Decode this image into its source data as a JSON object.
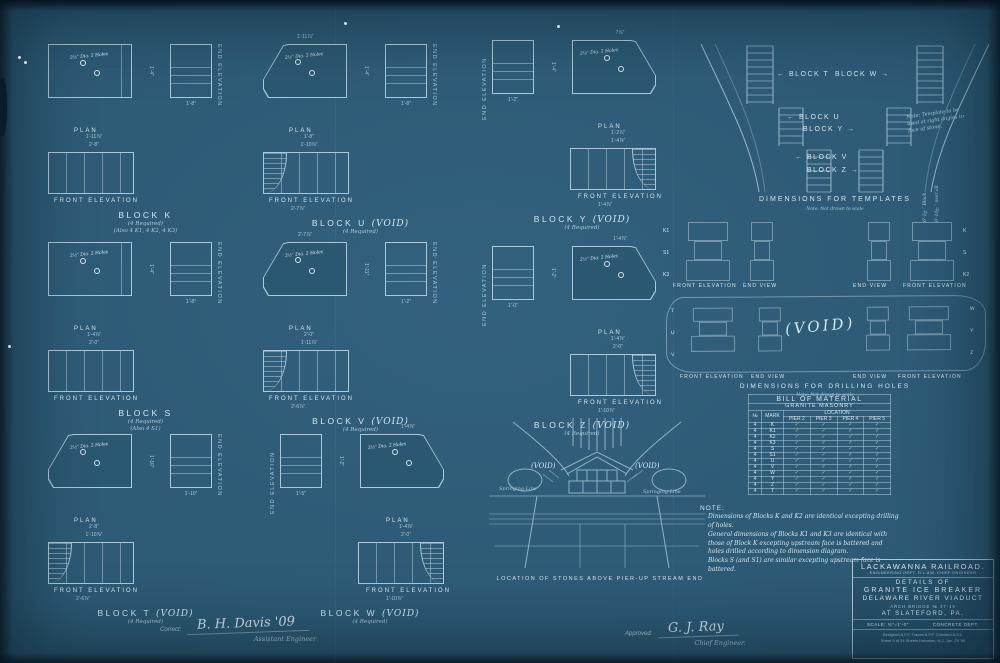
{
  "labels": {
    "plan": "PLAN",
    "front": "FRONT ELEVATION",
    "end": "END ELEVATION"
  },
  "blocks": [
    {
      "title": "BLOCK K",
      "void": "",
      "required": "(4 Required)",
      "extra": "(Also 4 K1, 4 K2, 4 K3)",
      "holes": "2½″ Dia. 2 Holes",
      "top_dim": "",
      "dim1": "1'-11⅞″",
      "dim2": "2'-8″",
      "side_dim": "1'-4″",
      "ee_dim": "1'-8″",
      "fe_dim": ""
    },
    {
      "title": "BLOCK U",
      "void": "(VOID)",
      "required": "(4 Required)",
      "extra": "",
      "holes": "2½″ Dia. 2 Holes",
      "top_dim": "1'-11⅞″",
      "dim1": "1'-8″",
      "dim2": "1'-10⅞″",
      "side_dim": "1'-4″",
      "ee_dim": "1'-8″",
      "fe_dim": "2'-7⅞″"
    },
    {
      "title": "BLOCK Y",
      "void": "(VOID)",
      "required": "(4 Required)",
      "extra": "",
      "holes": "2½″ Dia. 2 Holes",
      "top_dim": "7⅞″",
      "dim1": "1'-2⅞″",
      "dim2": "1'-4⅞″",
      "side_dim": "1'-4″",
      "ee_dim": "1'-2″",
      "fe_dim": "1'-4⅞″"
    },
    {
      "title": "BLOCK S",
      "void": "",
      "required": "(4 Required)",
      "extra": "(Also 4 S1)",
      "holes": "2½″ Dia. 2 Holes",
      "top_dim": "",
      "dim1": "1'-4⅞″",
      "dim2": "2'-0″",
      "side_dim": "1'-4″",
      "ee_dim": "1'-8″",
      "fe_dim": ""
    },
    {
      "title": "BLOCK V",
      "void": "(VOID)",
      "required": "(4 Required)",
      "extra": "",
      "holes": "2½″ Dia. 2 Holes",
      "top_dim": "2'-7⅞″",
      "dim1": "2'-0″",
      "dim2": "1'-11⅞″",
      "side_dim": "1'-11″",
      "ee_dim": "1'-2″",
      "fe_dim": "2'-6⅞″"
    },
    {
      "title": "BLOCK Z",
      "void": "(VOID)",
      "required": "(4 Required)",
      "extra": "",
      "holes": "2½″ Dia. 2 Holes",
      "top_dim": "1'-4⅞″",
      "dim1": "1'-4⅞″",
      "dim2": "2'-0″",
      "side_dim": "1'-2″",
      "ee_dim": "1'-0″",
      "fe_dim": "1'-10⅞″"
    },
    {
      "title": "BLOCK T",
      "void": "(VOID)",
      "required": "(4 Required)",
      "extra": "",
      "holes": "2½″ Dia. 2 Holes",
      "top_dim": "",
      "dim1": "2'-8″",
      "dim2": "1'-10⅞″",
      "side_dim": "1'-10″",
      "ee_dim": "1'-10″",
      "fe_dim": "2'-6⅞″"
    },
    {
      "title": "BLOCK W",
      "void": "(VOID)",
      "required": "(4 Required)",
      "extra": "",
      "holes": "2½″ Dia. 2 Holes",
      "top_dim": "1'-4⅞″",
      "dim1": "1'-4⅞″",
      "dim2": "2'-0″",
      "side_dim": "1'-2″",
      "ee_dim": "1'-5″",
      "fe_dim": "1'-10⅞″"
    }
  ],
  "templates": {
    "caption": "DIMENSIONS FOR TEMPLATES",
    "subcaption": "Note: Not drawn to scale",
    "side_note": "Note: Template to be used at right angles to face of stone.",
    "t": "BLOCK T",
    "w": "BLOCK W",
    "u": "BLOCK U",
    "y": "BLOCK Y",
    "v": "BLOCK V",
    "z": "BLOCK Z",
    "vdim1": "6'-1¼″ Block",
    "vdim2": "6'-10½″ over all"
  },
  "drilling": {
    "caption": "DIMENSIONS FOR DRILLING HOLES",
    "subcaption": "Note: Not drawn to scale",
    "fe": "FRONT ELEVATION",
    "ev": "END VIEW",
    "upper_left_marks": [
      "K1",
      "S1",
      "K3"
    ],
    "upper_right_marks": [
      "K",
      "S",
      "K2"
    ],
    "lower_left_marks": [
      "T",
      "U",
      "V"
    ],
    "lower_right_marks": [
      "W",
      "Y",
      "Z"
    ],
    "void": "(VOID)"
  },
  "stones": {
    "caption": "LOCATION OF STONES ABOVE PIER-UP STREAM END",
    "void": "(VOID)",
    "springing": "Springing Line"
  },
  "bom": {
    "title": "BILL OF MATERIAL",
    "subtitle": "GRANITE MASONRY",
    "no": "№",
    "mark": "MARK",
    "location": "LOCATION",
    "piers": [
      "PIER 2",
      "PIER 3",
      "PIER 4",
      "PIER 5"
    ],
    "rows": [
      {
        "no": "4",
        "mark": "K",
        "c": [
          "✓",
          "✓",
          "✓",
          "✓"
        ]
      },
      {
        "no": "4",
        "mark": "K1",
        "c": [
          "✓",
          "✓",
          "✓",
          "✓"
        ]
      },
      {
        "no": "4",
        "mark": "K2",
        "c": [
          "✓",
          "✓",
          "✓",
          "✓"
        ]
      },
      {
        "no": "4",
        "mark": "K3",
        "c": [
          "✓",
          "✓",
          "✓",
          "✓"
        ]
      },
      {
        "no": "4",
        "mark": "S",
        "c": [
          "✓",
          "✓",
          "✓",
          "✓"
        ]
      },
      {
        "no": "4",
        "mark": "S1",
        "c": [
          "✓",
          "✓",
          "✓",
          "✓"
        ]
      },
      {
        "no": "4",
        "mark": "U",
        "c": [
          "✓",
          "✓",
          "✓",
          "✓"
        ]
      },
      {
        "no": "4",
        "mark": "V",
        "c": [
          "✓",
          "✓",
          "✓",
          "✓"
        ]
      },
      {
        "no": "4",
        "mark": "W",
        "c": [
          "✓",
          "✓",
          "✓",
          "✓"
        ]
      },
      {
        "no": "4",
        "mark": "Y",
        "c": [
          "✓",
          "✓",
          "✓",
          "✓"
        ]
      },
      {
        "no": "4",
        "mark": "Z",
        "c": [
          "✓",
          "✓",
          "✓",
          "✓"
        ]
      },
      {
        "no": "4",
        "mark": "T",
        "c": [
          "✓",
          "✓",
          "✓",
          "✓"
        ]
      }
    ]
  },
  "note": {
    "label": "NOTE:",
    "lines": [
      "Dimensions of Blocks K and K2 are identical excepting drilling of holes.",
      "General dimensions of Blocks K1 and K3 are identical with those of Block K excepting upstream face is battered and holes drilled according to dimension diagram.",
      "Blocks S (and S1) are similar excepting upstream face is battered."
    ]
  },
  "titleblock": {
    "railroad": "LACKAWANNA RAILROAD.",
    "dept": "ENGINEERING DEPT.  D.L.&W.  CHIEF ENGINEER",
    "details": "DETAILS OF",
    "subject1": "GRANITE ICE BREAKER",
    "subject2": "DELAWARE RIVER VIADUCT",
    "bridge": "ARCH BRIDGE № 27-19",
    "location": "AT SLATEFORD, PA.",
    "scale": "SCALE: ¾″=1'-0″",
    "dept2": "CONCRETE DEPT.",
    "credits": "Designed A.F.F.   Traced A.F.F.   Checked A.S.L.",
    "sheetinfo": "Sheet 9 of 24 Sheets    Hoboken, N.J.  Jan. 29 '09"
  },
  "signatures": {
    "correct_label": "Correct:",
    "correct_sig": "B. H. Davis  '09",
    "correct_title": "Assistant Engineer",
    "approved_label": "Approved:",
    "approved_sig": "G. J. Ray",
    "approved_title": "Chief Engineer."
  }
}
